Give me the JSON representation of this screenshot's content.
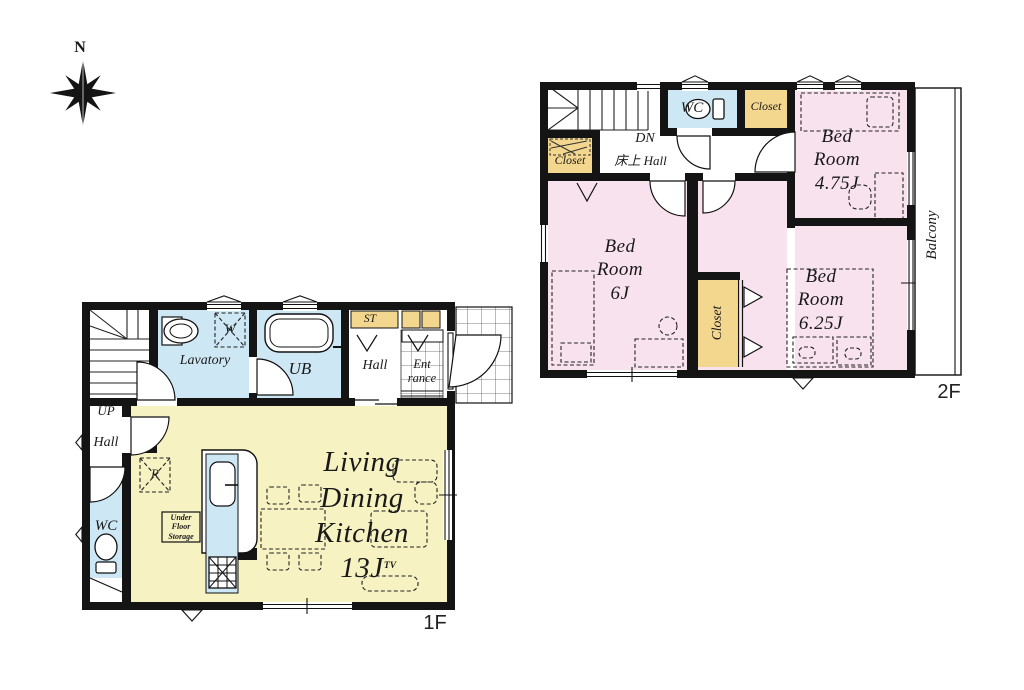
{
  "palette": {
    "wall": "#141414",
    "ink": "#191919",
    "pink": "#f8e2ee",
    "yellow": "#f7f2c2",
    "blue": "#cde8f4",
    "closet": "#f4d78f",
    "paper": "#ffffff"
  },
  "compass": {
    "north_label": "N"
  },
  "floor2": {
    "floor_label": "2F",
    "stairs_label": "DN",
    "hall_label": "床上  Hall",
    "wc_label": "WC",
    "closet_top_label": "Closet",
    "closet_left_label": "Closet",
    "closet_mid_label": "Closet",
    "balcony_label": "Balcony",
    "bedroom_475_label": "Bed\nRoom\n4.75J",
    "bedroom_6_label": "Bed\nRoom\n6J",
    "bedroom_625_label": "Bed\nRoom\n6.25J"
  },
  "floor1": {
    "floor_label": "1F",
    "ldk_label": "Living\nDining\nKitchen\n13J",
    "lavatory_label": "Lavatory",
    "washer_label": "W",
    "bath_label": "UB",
    "storage_label": "ST",
    "hall_entrance_label": "Hall",
    "entrance_label": "Ent\nrance",
    "stairs_label": "UP",
    "hall_west_label": "Hall",
    "wc_label": "WC",
    "fridge_label": "R",
    "under_floor_storage_label": "Under\nFloor\nStorage",
    "tv_label": "TV"
  }
}
